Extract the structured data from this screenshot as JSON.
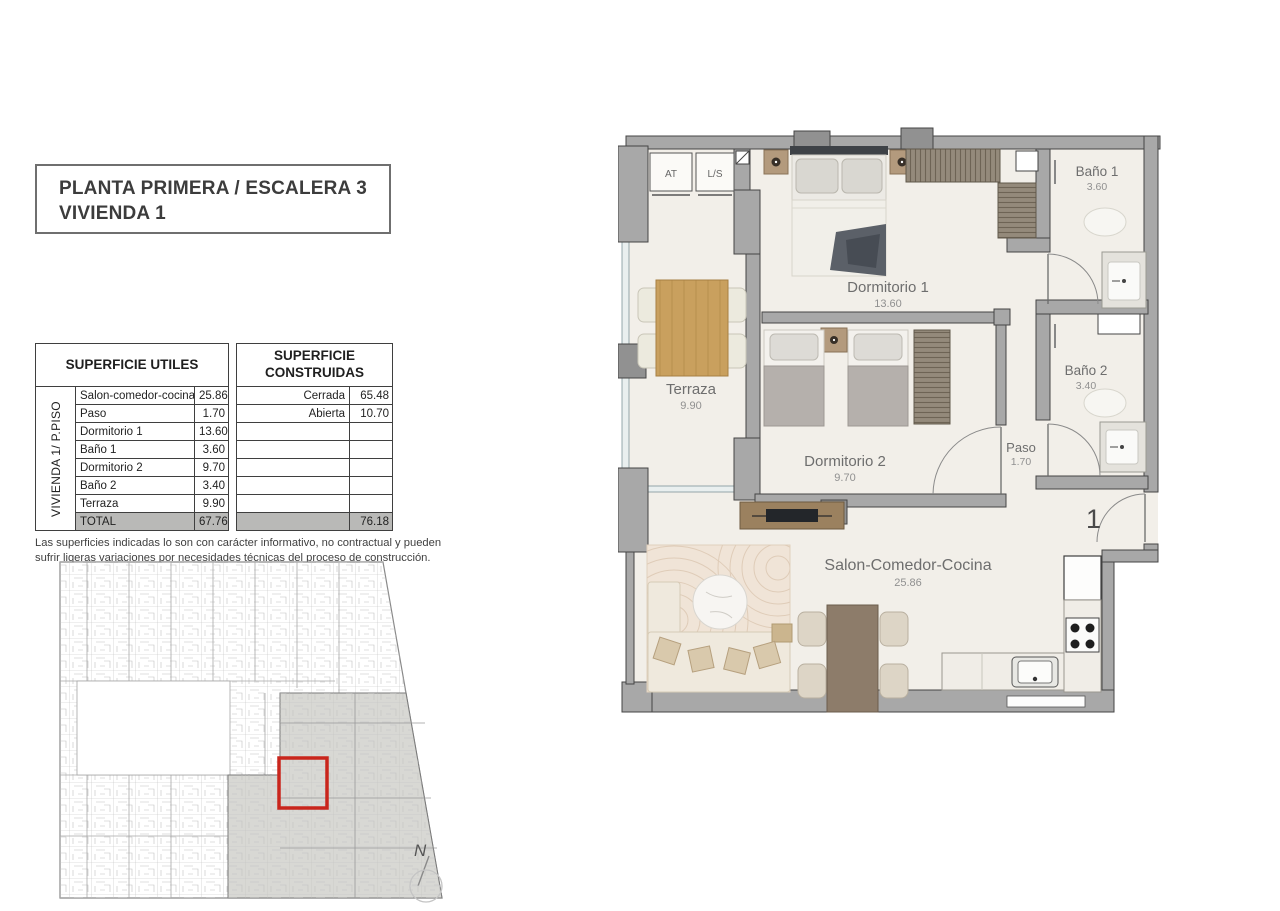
{
  "header": {
    "line1": "PLANTA PRIMERA / ESCALERA 3",
    "line2": "VIVIENDA 1"
  },
  "table": {
    "header_left": "SUPERFICIE UTILES",
    "header_right": "SUPERFICIE CONSTRUIDAS",
    "side_label": "VIVIENDA 1/ P.PISO",
    "utiles": [
      {
        "name": "Salon-comedor-cocina",
        "value": "25.86"
      },
      {
        "name": "Paso",
        "value": "1.70"
      },
      {
        "name": "Dormitorio 1",
        "value": "13.60"
      },
      {
        "name": "Baño 1",
        "value": "3.60"
      },
      {
        "name": "Dormitorio 2",
        "value": "9.70"
      },
      {
        "name": "Baño 2",
        "value": "3.40"
      },
      {
        "name": "Terraza",
        "value": "9.90"
      }
    ],
    "construidas": [
      {
        "label": "Cerrada",
        "value": "65.48"
      },
      {
        "label": "Abierta",
        "value": "10.70"
      }
    ],
    "total_label": "TOTAL",
    "total_utiles": "67.76",
    "total_construidas": "76.18"
  },
  "disclaimer": "Las superficies indicadas lo son con carácter informativo, no contractual y pueden sufrir ligeras variaciones por necesidades técnicas del proceso de construcción.",
  "plan": {
    "rooms": {
      "terraza": {
        "name": "Terraza",
        "area": "9.90"
      },
      "dormitorio1": {
        "name": "Dormitorio 1",
        "area": "13.60"
      },
      "dormitorio2": {
        "name": "Dormitorio 2",
        "area": "9.70"
      },
      "bano1": {
        "name": "Baño 1",
        "area": "3.60"
      },
      "bano2": {
        "name": "Baño 2",
        "area": "3.40"
      },
      "paso": {
        "name": "Paso",
        "area": "1.70"
      },
      "salon": {
        "name": "Salon-Comedor-Cocina",
        "area": "25.86"
      }
    },
    "closets": {
      "at": "AT",
      "ls": "L/S"
    },
    "unit_number": "1"
  },
  "compass": {
    "label": "N"
  },
  "colors": {
    "highlight_red": "#c9251c",
    "wall_gray": "#a8a8a8",
    "floor_cream": "#f2efe9",
    "shaded_unit_gray": "#d8d8d4",
    "wood": "#c9a05e"
  }
}
